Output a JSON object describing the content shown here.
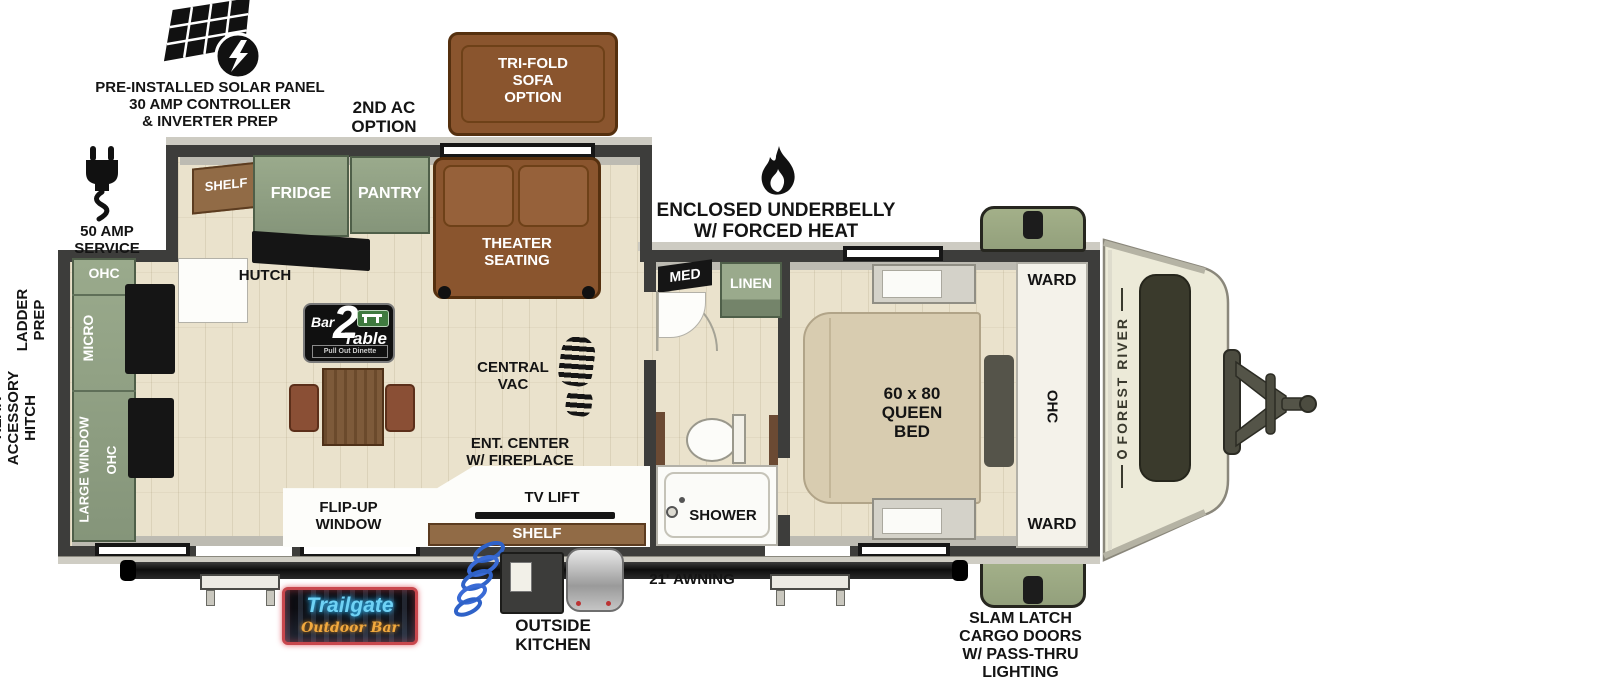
{
  "callouts": {
    "solar": "PRE-INSTALLED SOLAR PANEL\n30 AMP CONTROLLER\n& INVERTER PREP",
    "second_ac": "2ND AC\nOPTION",
    "trifold": "TRI-FOLD\nSOFA\nOPTION",
    "underbelly": "ENCLOSED UNDERBELLY\nW/ FORCED HEAT",
    "amp50": "50 AMP SERVICE",
    "ladder": "LADDER\nPREP",
    "rear_hitch": "REAR\nACCESSORY\nHITCH",
    "awning": "21' AWNING",
    "outside_kitchen": "OUTSIDE\nKITCHEN",
    "cargo": "SLAM LATCH\nCARGO DOORS\nW/ PASS-THRU\nLIGHTING"
  },
  "living": {
    "ohc_top": "OHC",
    "micro": "MICRO",
    "large_window": "LARGE WINDOW",
    "ohc_side": "OHC",
    "shelf_top": "SHELF",
    "fridge": "FRIDGE",
    "pantry": "PANTRY",
    "hutch": "HUTCH",
    "theater": "THEATER\nSEATING",
    "central_vac": "CENTRAL\nVAC",
    "ent_center": "ENT. CENTER\nW/ FIREPLACE",
    "tv_lift": "TV LIFT",
    "shelf_bottom": "SHELF",
    "flip_up": "FLIP-UP\nWINDOW"
  },
  "dinette": {
    "bar": "Bar",
    "two": "2",
    "table": "Table",
    "tagline": "Pull Out Dinette"
  },
  "bath": {
    "med": "MED",
    "linen": "LINEN",
    "shower": "SHOWER"
  },
  "bedroom": {
    "bed": "60 x 80\nQUEEN\nBED",
    "ward_top": "WARD",
    "ohc": "OHC",
    "ward_bottom": "WARD"
  },
  "brand": "FOREST RIVER",
  "outdoor_bar": {
    "name": "Trailgate",
    "sub": "Outdoor Bar"
  },
  "colors": {
    "wall": "#3d3d3b",
    "floor": "#eae2cc",
    "cabinet_green": "#8d9d7f",
    "sofa_brown": "#8a552e",
    "wood_brown": "#916b46",
    "bed_beige": "#d8ccb0",
    "cargo_green": "#9aa783",
    "cap_cream": "#ecead8",
    "neon_blue": "#6fd2f5",
    "neon_orange": "#f2a93e",
    "neon_red": "#c8474d"
  }
}
